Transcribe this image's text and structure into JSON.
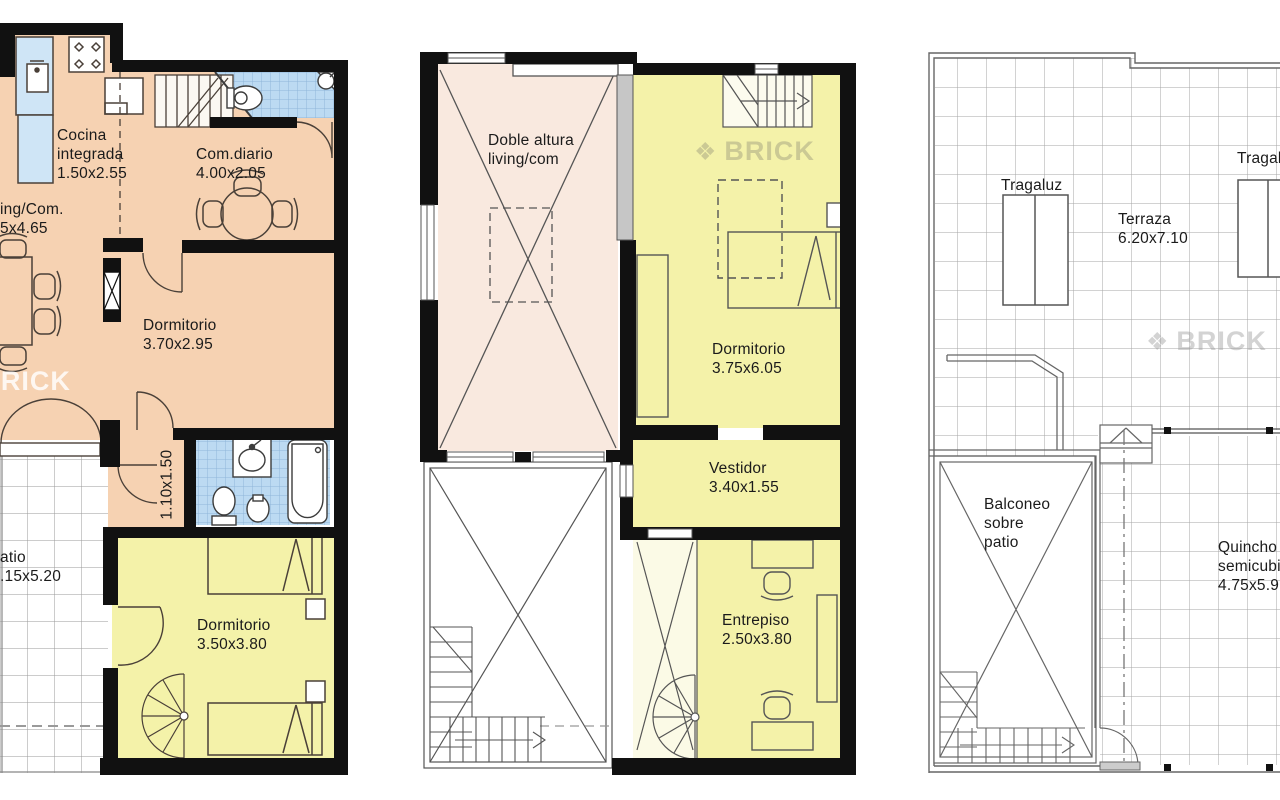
{
  "sheet": {
    "title_visible": "",
    "type": "floor-plan-sheet"
  },
  "watermark": {
    "logo": "❖",
    "text": "BRICK"
  },
  "colors": {
    "wall": "#111111",
    "floor_living": "#f6d2b2",
    "floor_bedroom": "#f4f2a9",
    "floor_void_pink": "#f9e9df",
    "floor_void_pale": "#fbfae6",
    "bath_tile": "#bcdaf2",
    "counter_blue": "#cfe5f6",
    "gray_wall": "#c6c6c6",
    "paper": "#ffffff"
  },
  "plan1": {
    "labels": {
      "cocina": "Cocina\nintegrada\n1.50x2.55",
      "living_cut": "ing/Com.\n5x4.65",
      "comdiario": "Com.diario\n4.00x2.05",
      "dormitorio_1": "Dormitorio\n3.70x2.95",
      "paso": "1.10x1.50",
      "patio_cut": "atio\n.15x5.20",
      "dormitorio_2": "Dormitorio\n3.50x3.80"
    }
  },
  "plan2": {
    "labels": {
      "doble_altura": "Doble altura\nliving/com",
      "dormitorio": "Dormitorio\n3.75x6.05",
      "vestidor": "Vestidor\n3.40x1.55",
      "entrepiso": "Entrepiso\n2.50x3.80"
    }
  },
  "plan3": {
    "labels": {
      "tragaluz_1": "Tragaluz",
      "tragaluz_2_cut": "Tragal",
      "terraza": "Terraza\n6.20x7.10",
      "balconeo": "Balconeo\nsobre\npatio",
      "quincho_cut": "Quincho\nsemicubi\n4.75x5.9"
    }
  }
}
